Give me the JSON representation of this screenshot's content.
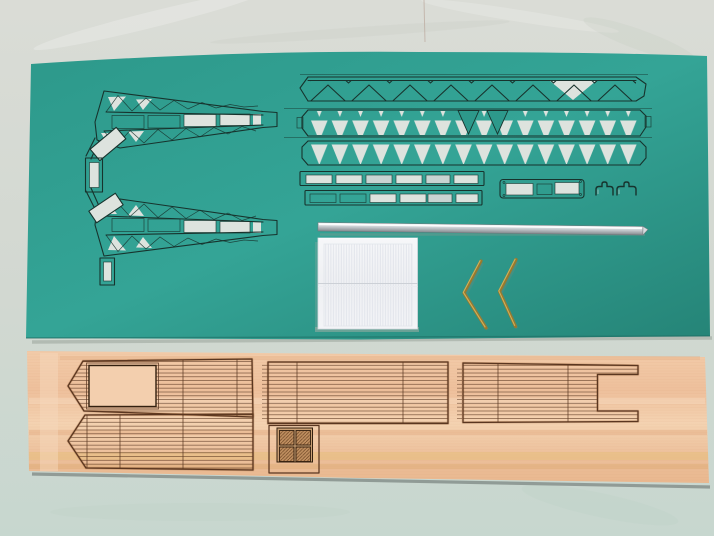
{
  "meta": {
    "type": "photograph",
    "subject": "Laser-cut model ship kit parts arranged on a tabletop"
  },
  "colors": {
    "bg_top": "#dadcd6",
    "bg_mid": "#d2d8d1",
    "bg_bottom": "#c7d7cf",
    "card_teal": "#2d998b",
    "card_teal_light": "#34a496",
    "card_teal_dark": "#258477",
    "cut": "#17332d",
    "backing": "#dde3de",
    "backing_blue": "#c9d4d2",
    "wood_base": "#eec29f",
    "wood_light": "#f6d8bc",
    "wood_streak": "#e3ab80",
    "wood_yellow": "#e8bf7d",
    "etch": "#5a3620",
    "etch_dark": "#33200f",
    "burn": "#8a4f22",
    "rod_light": "#f8fafb",
    "rod_mid": "#c7ccd0",
    "rod_dark": "#84898e",
    "panel_white": "#f2f3f6",
    "panel_rib": "#dfe2e9",
    "brass": "#97792f",
    "brass_light": "#d2b45e",
    "shadow": "#8e988f"
  },
  "scene": {
    "background": {
      "name": "tabletop-background"
    },
    "card_sheet": {
      "name": "teal-card-sheet",
      "parts": [
        "crane-jib-frame-upper",
        "crane-jib-frame-lower",
        "tilted-brace-plate-upper",
        "tilted-brace-plate-lower",
        "slotted-connector-plate",
        "slotted-foot-plate",
        "lattice-girder-strip",
        "warren-truss-strip-upper",
        "warren-truss-strip-lower",
        "slotted-rail-strip-upper",
        "slotted-rail-strip-lower",
        "rounded-base-plate",
        "wire-clip-left",
        "wire-clip-right"
      ]
    },
    "wood_sheet": {
      "name": "wood-veneer-sheet",
      "parts": [
        "bow-deck-with-opening",
        "bow-deck-solid",
        "mid-deck-panel",
        "stern-deck-panel-notched",
        "hatch-cover-four-panel"
      ]
    },
    "loose_parts": [
      "aluminium-rod",
      "corrugated-white-panel",
      "brass-wire-chevron-left",
      "brass-wire-chevron-right"
    ]
  }
}
